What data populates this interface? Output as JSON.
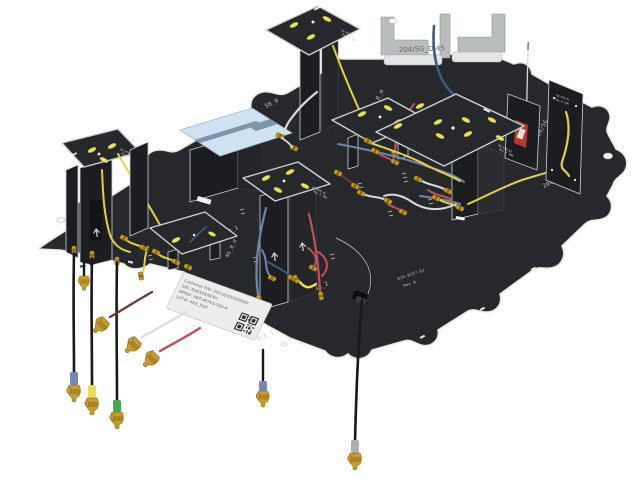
{
  "colors": {
    "board": "#26282b",
    "board-dark": "#1b1d20",
    "board-edge": "#e6e7e6",
    "edge-lite": "#cfd1d2",
    "pad": "#e8e35a",
    "gold": "#c79b2e",
    "gold-dark": "#8a6a14",
    "metal": "#b9bdbe",
    "pifa": "#cfe2f1",
    "pifa-slot": "#7e94a9",
    "cable-yellow": "#e0d149",
    "cable-red": "#c05158",
    "cable-darkred": "#6f3a32",
    "cable-blue": "#6e87b0",
    "cable-navy": "#3f5a7d",
    "cable-white": "#dcdcda",
    "cable-black": "#17181a",
    "boot-blue": "#7189b4",
    "boot-yellow": "#e7e05a",
    "boot-green": "#3fae4a",
    "boot-gray": "#aab0b3",
    "silk": "#c6c8ca",
    "label": "#ededeb",
    "label-text": "#63635e"
  },
  "bracket": {
    "label": "204/5G_D-45"
  },
  "board": {
    "refs": {
      "ref_50_0": "50_0",
      "ref_4g_0_h": "4G_0_H",
      "ref_40_1": "40_1",
      "ref_45_2": "45_2",
      "ref_ble_1": "BLE_1",
      "ref_204_5g": "204/5G",
      "ref_204_5g_d_v": "204/5G_D_V",
      "part_number": "019-0237-01",
      "revision": "Rev B"
    },
    "stand_marking": {
      "line1": "OV-HTN-01",
      "line2": "Rev A TNM"
    }
  },
  "product_label": {
    "line1": "Customer P/N: 203-0203/0203HP",
    "line2": "S/N: XXXXXXXXXX",
    "line3": "MPN#: ANT-AP763-763-A",
    "line4": "LOT#: XXX_XXX"
  }
}
